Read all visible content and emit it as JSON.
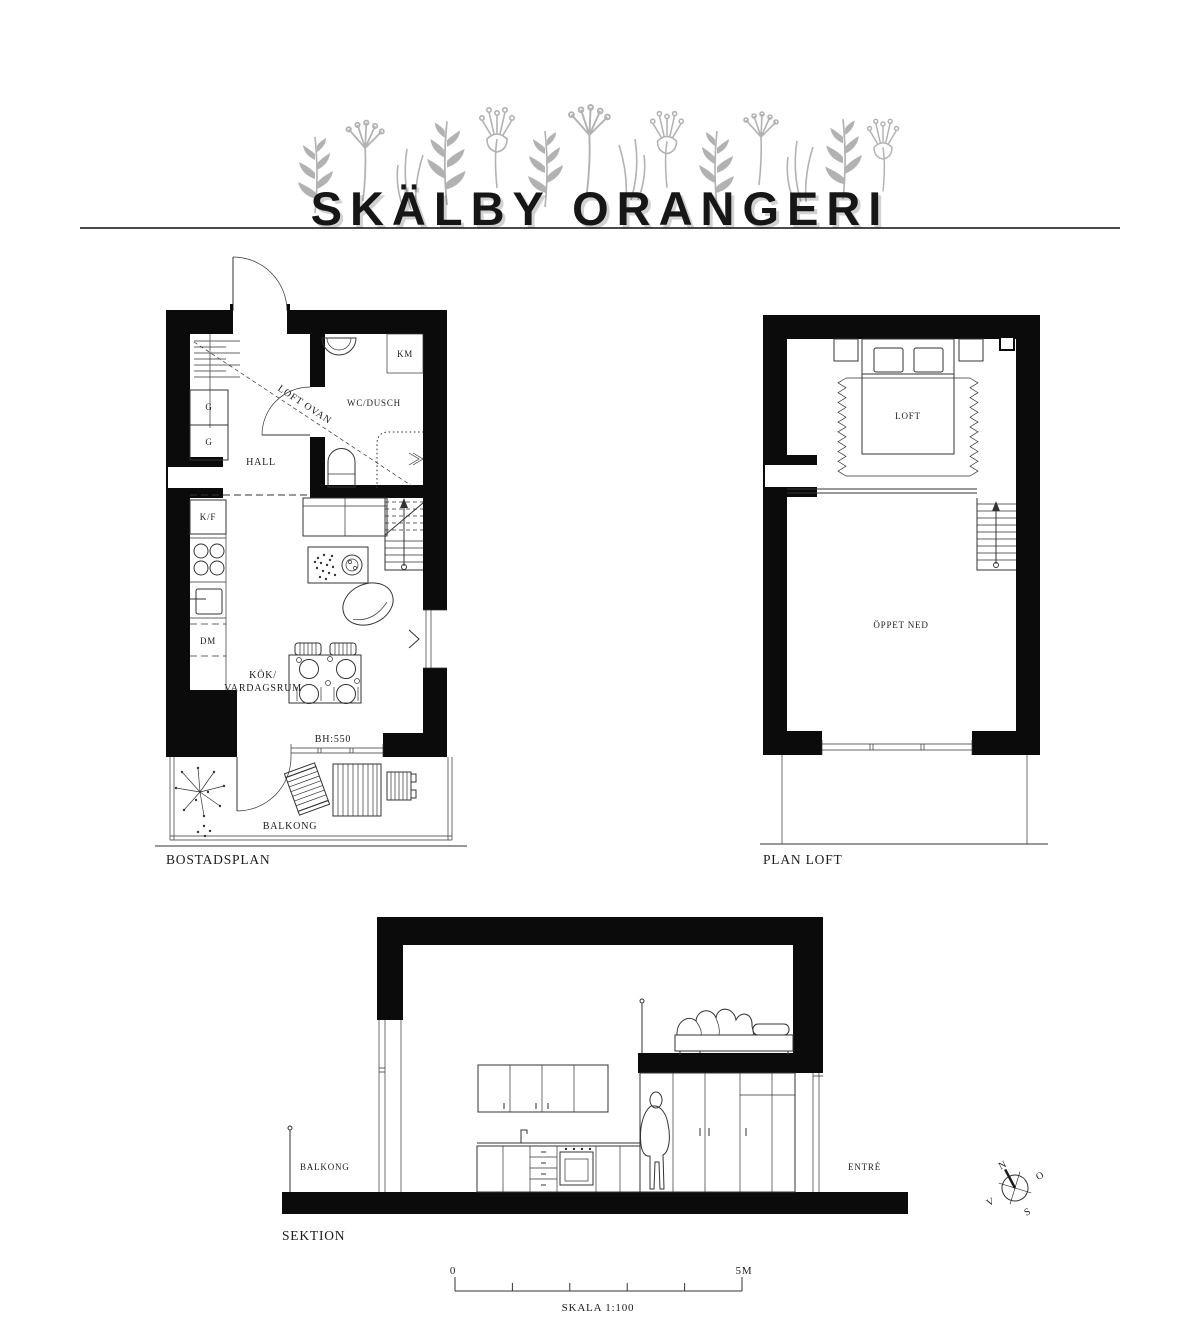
{
  "title": "SKÄLBY ORANGERI",
  "bostadsplan": {
    "label": "BOSTADSPLAN",
    "rooms": {
      "hall": "HALL",
      "wc": "WC/DUSCH",
      "km": "KM",
      "g1": "G",
      "g2": "G",
      "kf": "K/F",
      "dm": "DM",
      "kok_line1": "KÖK/",
      "kok_line2": "VARDAGSRUM",
      "loft_ovan": "LOFT OVAN",
      "bh": "BH:550",
      "balkong": "BALKONG"
    }
  },
  "plan_loft": {
    "label": "PLAN LOFT",
    "rooms": {
      "loft": "LOFT",
      "oppet_ned": "ÖPPET NED"
    }
  },
  "sektion": {
    "label": "SEKTION",
    "balkong": "BALKONG",
    "entre": "ENTRÉ"
  },
  "scalebar": {
    "start": "0",
    "end": "5M",
    "caption": "SKALA 1:100"
  },
  "compass": {
    "n": "N",
    "e": "O",
    "s": "S",
    "w": "V"
  },
  "colors": {
    "ink": "#1c1c1c",
    "wall": "#0b0b0b",
    "line": "#333333",
    "decoration": "#b2b2b2"
  }
}
